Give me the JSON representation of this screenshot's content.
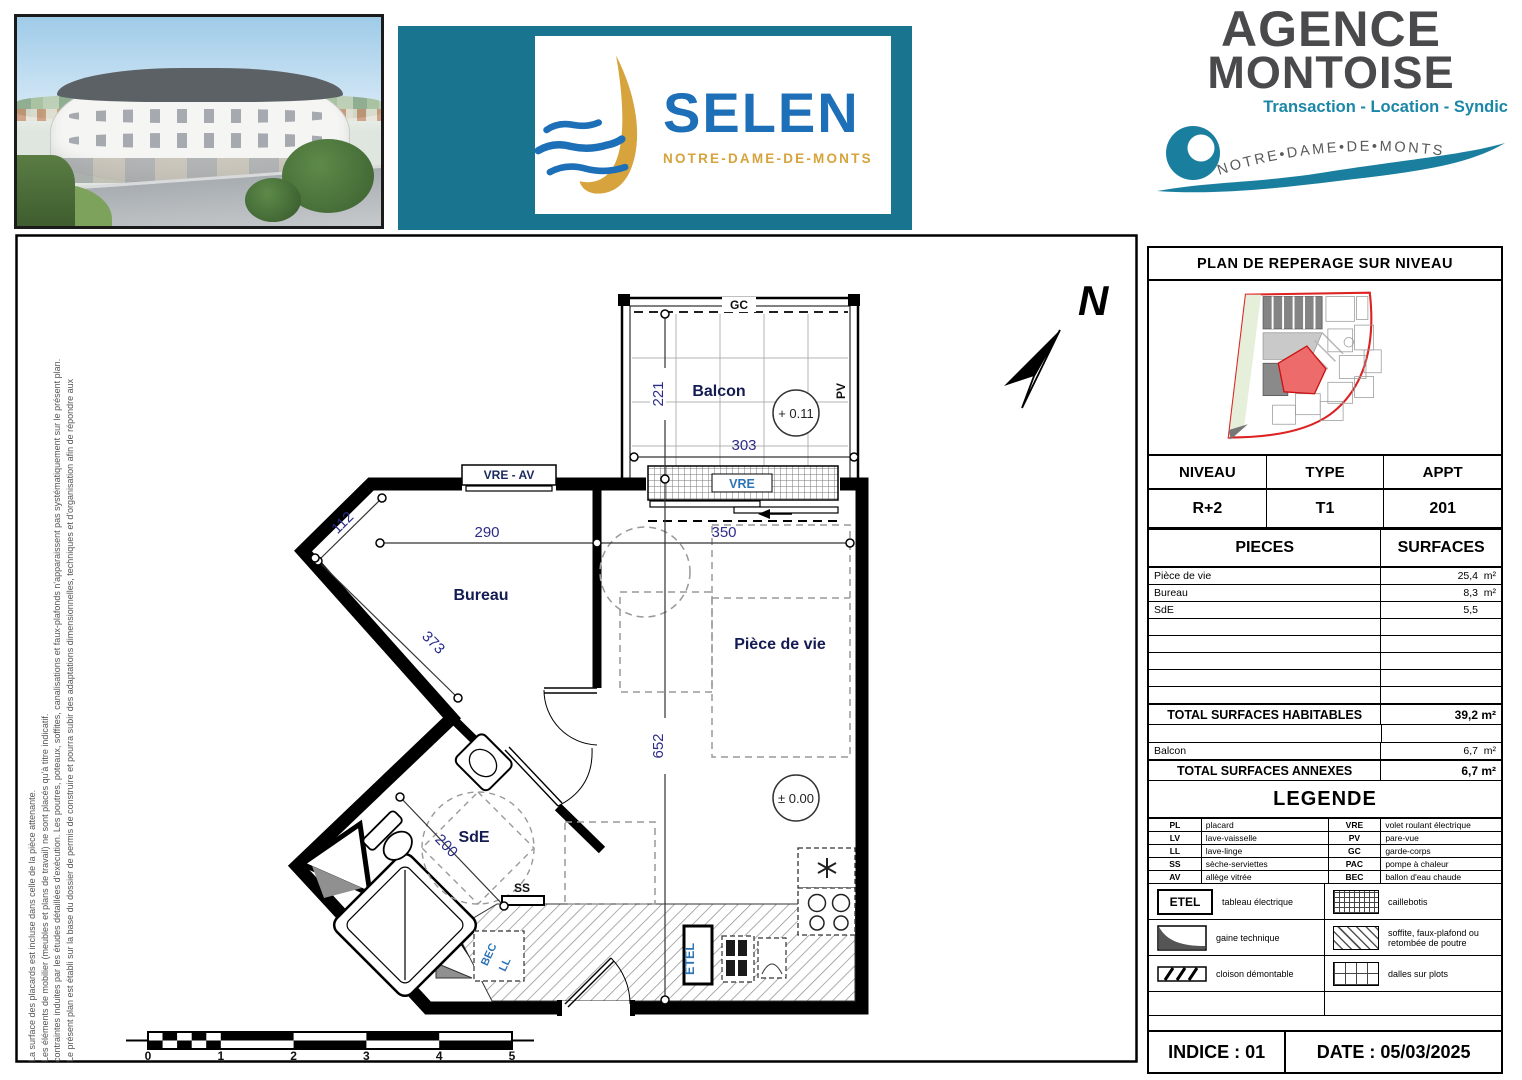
{
  "colors": {
    "banner_teal": "#19748f",
    "selen_blue": "#1d6fb8",
    "selen_gold": "#d6a33c",
    "agence_gray": "#4a4a4c",
    "agence_teal": "#1b87a8",
    "dim_blue": "#2c2c8a",
    "label_blue": "#2e74b5",
    "site_outline_red": "#dd2222",
    "site_highlight_red": "#ee6b6b"
  },
  "header": {
    "selen": {
      "name": "SELEN",
      "subtitle": "NOTRE-DAME-DE-MONTS"
    },
    "agence": {
      "title_line1": "AGENCE",
      "title_line2": "MONTOISE",
      "services": "Transaction - Location - Syndic",
      "arc_text": "NOTRE•DAME•DE•MONTS"
    }
  },
  "disclaimer": {
    "line1": "Le présent plan est établi sur la base du dossier de permis de construire et pourra subir des adaptations dimensionnelles, techniques et d'organisation afin de répondre aux",
    "line2": "contraintes induites par les études détaillées d'exécution. Les poutres, poteaux, soffites, canalisations et faux-plafonds n'apparaissent pas systématiquement sur le présent plan.",
    "line3": "Les éléments de mobilier (meubles et plans de travail) ne sont placés qu'à titre indicatif.",
    "line4": "La surface des placards est incluse dans celle de la pièce attenante."
  },
  "plan": {
    "north_label": "N",
    "rooms": {
      "balcon": "Balcon",
      "bureau": "Bureau",
      "piece_de_vie": "Pièce de vie",
      "sde": "SdE"
    },
    "labels": {
      "gc": "GC",
      "pv": "PV",
      "vre": "VRE",
      "vre_av": "VRE - AV",
      "ss": "SS",
      "etel": "ETEL",
      "bec": "BEC",
      "ll": "LL"
    },
    "dims": {
      "d112": "112",
      "d200": "200",
      "d221": "221",
      "d290": "290",
      "d303": "303",
      "d350": "350",
      "d373": "373",
      "d652": "652"
    },
    "levels": {
      "balcony": "+ 0.11",
      "floor": "± 0.00"
    },
    "scale": [
      "0",
      "1",
      "2",
      "3",
      "4",
      "5"
    ]
  },
  "panel": {
    "title": "PLAN DE REPERAGE SUR NIVEAU",
    "info": {
      "headers": [
        "NIVEAU",
        "TYPE",
        "APPT"
      ],
      "values": [
        "R+2",
        "T1",
        "201"
      ]
    },
    "surfaces": {
      "headers": [
        "PIECES",
        "SURFACES"
      ],
      "rows": [
        {
          "label": "Pièce de vie",
          "value": "25,4",
          "unit": "m²"
        },
        {
          "label": "Bureau",
          "value": "8,3",
          "unit": "m²"
        },
        {
          "label": "SdE",
          "value": "5,5",
          "unit": "m²"
        }
      ],
      "total_habitables": {
        "label": "TOTAL SURFACES HABITABLES",
        "value": "39,2 m²"
      },
      "annexes_rows": [
        {
          "label": "Balcon",
          "value": "6,7",
          "unit": "m²"
        }
      ],
      "total_annexes": {
        "label": "TOTAL SURFACES ANNEXES",
        "value": "6,7 m²"
      }
    },
    "legend": {
      "title": "LEGENDE",
      "abbr": [
        {
          "a": "PL",
          "d": "placard",
          "a2": "VRE",
          "d2": "volet roulant électrique"
        },
        {
          "a": "LV",
          "d": "lave-vaisselle",
          "a2": "PV",
          "d2": "pare-vue"
        },
        {
          "a": "LL",
          "d": "lave-linge",
          "a2": "GC",
          "d2": "garde-corps"
        },
        {
          "a": "SS",
          "d": "sèche-serviettes",
          "a2": "PAC",
          "d2": "pompe à chaleur"
        },
        {
          "a": "AV",
          "d": "allège vitrée",
          "a2": "BEC",
          "d2": "ballon d'eau chaude"
        }
      ],
      "symbols": [
        {
          "left": "tableau électrique",
          "right": "caillebotis"
        },
        {
          "left": "gaine technique",
          "right": "soffite, faux-plafond ou retombée de poutre"
        },
        {
          "left": "cloison démontable",
          "right": "dalles sur plots"
        }
      ],
      "etel_label": "ETEL"
    },
    "footer": {
      "indice": "INDICE : 01",
      "date": "DATE : 05/03/2025"
    }
  }
}
